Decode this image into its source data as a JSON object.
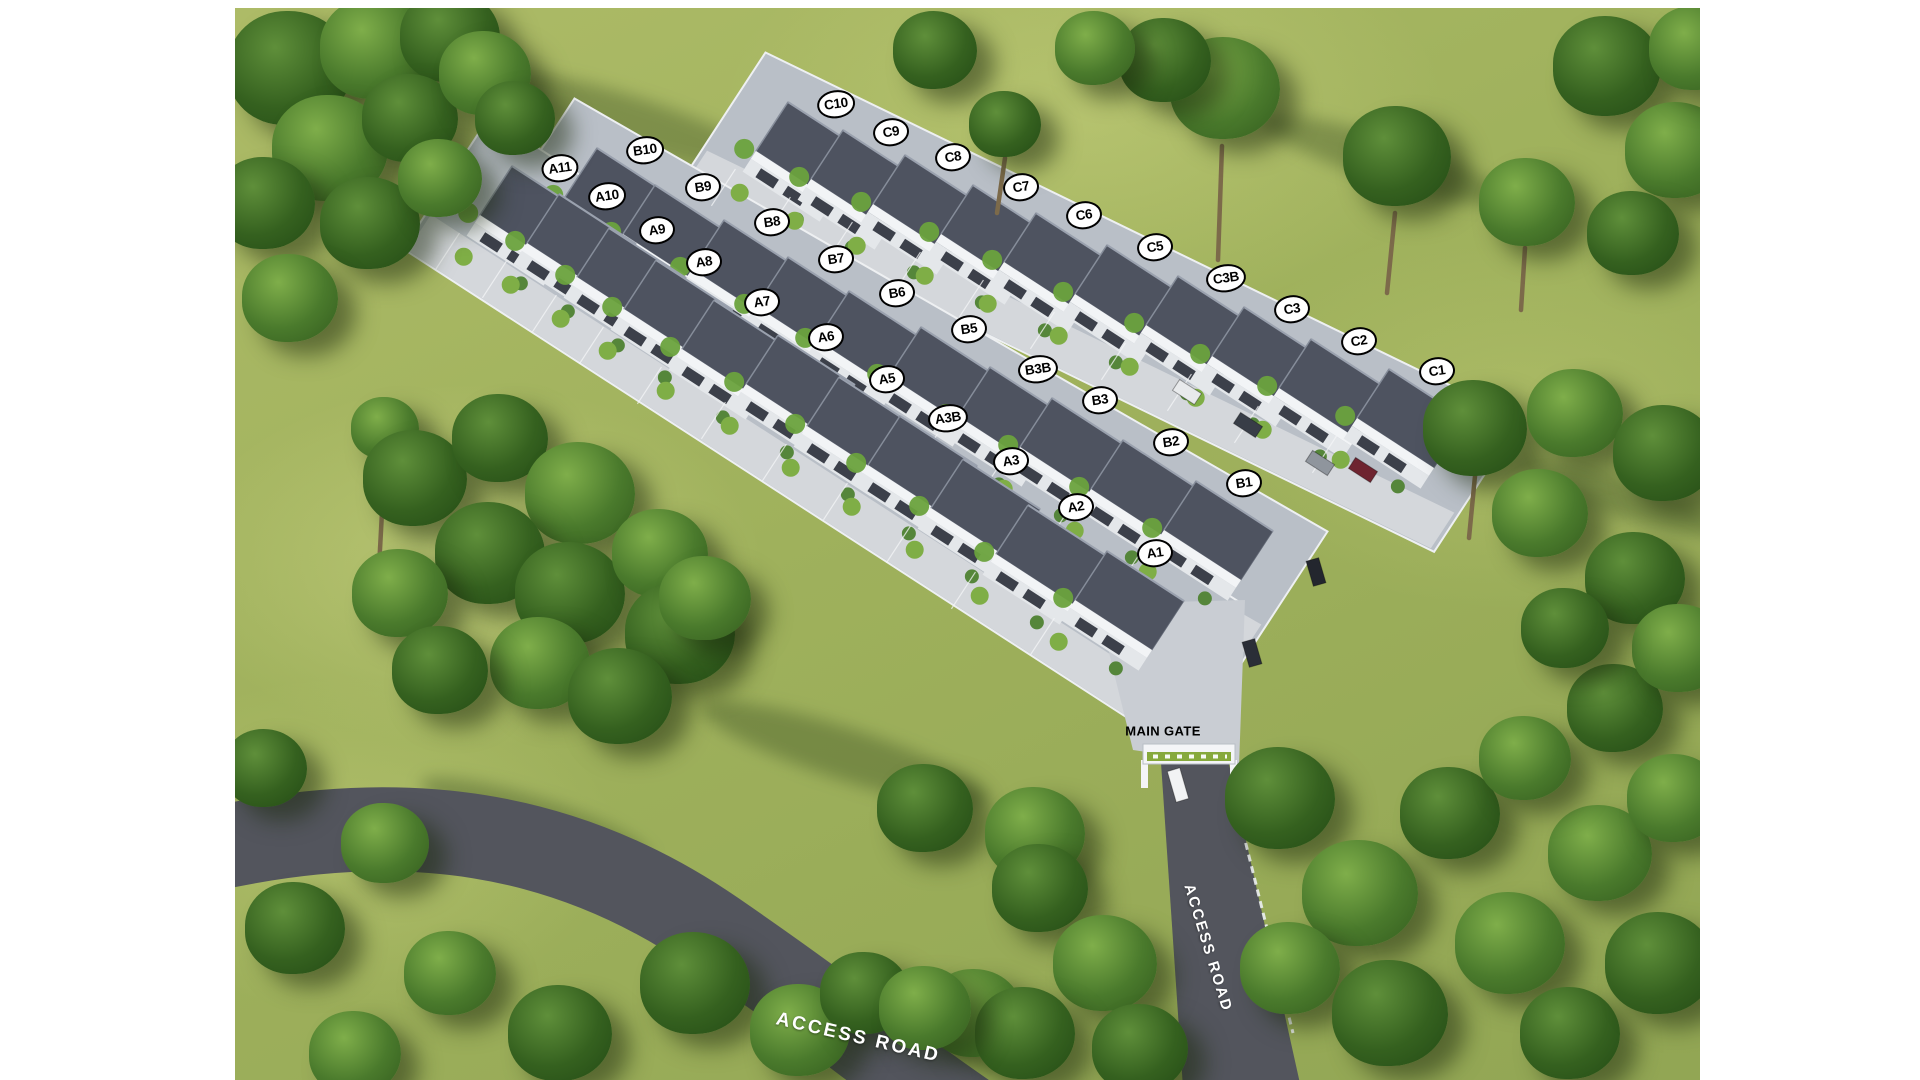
{
  "scene": {
    "type": "aerial-site-plan",
    "labels": {
      "main_gate": "MAIN GATE",
      "access_road_gate": "ACCESS ROAD",
      "access_road_main": "ACCESS ROAD"
    },
    "colors": {
      "grass": "#9fb15c",
      "tree_light": "#4a7a2c",
      "tree_dark": "#35611f",
      "road": "#53555d",
      "platform": "#b9bfc7",
      "driveway": "#d4d7db",
      "roof": "#4e5360",
      "facade": "#e4e7ea",
      "wall": "#eef0f2",
      "label_bg": "#ffffff",
      "label_border": "#000000",
      "gate_sign": "#86a93c"
    },
    "rows": [
      {
        "row": "A",
        "units": [
          {
            "id": "A11",
            "x": 325,
            "y": 160
          },
          {
            "id": "A10",
            "x": 372,
            "y": 188
          },
          {
            "id": "A9",
            "x": 422,
            "y": 222
          },
          {
            "id": "A8",
            "x": 469,
            "y": 254
          },
          {
            "id": "A7",
            "x": 527,
            "y": 294
          },
          {
            "id": "A6",
            "x": 591,
            "y": 329
          },
          {
            "id": "A5",
            "x": 652,
            "y": 371
          },
          {
            "id": "A3B",
            "x": 713,
            "y": 410
          },
          {
            "id": "A3",
            "x": 776,
            "y": 453
          },
          {
            "id": "A2",
            "x": 841,
            "y": 499
          },
          {
            "id": "A1",
            "x": 920,
            "y": 545
          }
        ]
      },
      {
        "row": "B",
        "units": [
          {
            "id": "B10",
            "x": 410,
            "y": 142
          },
          {
            "id": "B9",
            "x": 468,
            "y": 179
          },
          {
            "id": "B8",
            "x": 537,
            "y": 214
          },
          {
            "id": "B7",
            "x": 601,
            "y": 251
          },
          {
            "id": "B6",
            "x": 662,
            "y": 285
          },
          {
            "id": "B5",
            "x": 734,
            "y": 321
          },
          {
            "id": "B3B",
            "x": 803,
            "y": 361
          },
          {
            "id": "B3",
            "x": 865,
            "y": 392
          },
          {
            "id": "B2",
            "x": 936,
            "y": 434
          },
          {
            "id": "B1",
            "x": 1009,
            "y": 475
          }
        ]
      },
      {
        "row": "C",
        "units": [
          {
            "id": "C10",
            "x": 601,
            "y": 96
          },
          {
            "id": "C9",
            "x": 656,
            "y": 124
          },
          {
            "id": "C8",
            "x": 718,
            "y": 149
          },
          {
            "id": "C7",
            "x": 786,
            "y": 179
          },
          {
            "id": "C6",
            "x": 849,
            "y": 207
          },
          {
            "id": "C5",
            "x": 920,
            "y": 239
          },
          {
            "id": "C3B",
            "x": 991,
            "y": 270
          },
          {
            "id": "C3",
            "x": 1057,
            "y": 301
          },
          {
            "id": "C2",
            "x": 1124,
            "y": 333
          },
          {
            "id": "C1",
            "x": 1202,
            "y": 363
          }
        ]
      }
    ],
    "trees": [
      {
        "x": 55,
        "y": 60,
        "r": 62,
        "t": 1
      },
      {
        "x": 140,
        "y": 40,
        "r": 55,
        "t": 0
      },
      {
        "x": 215,
        "y": 28,
        "r": 50,
        "t": 1
      },
      {
        "x": 95,
        "y": 140,
        "r": 58,
        "t": 0
      },
      {
        "x": 30,
        "y": 195,
        "r": 50,
        "t": 1
      },
      {
        "x": 175,
        "y": 110,
        "r": 48,
        "t": 1
      },
      {
        "x": 250,
        "y": 65,
        "r": 46,
        "t": 0
      },
      {
        "x": 135,
        "y": 215,
        "r": 50,
        "t": 1
      },
      {
        "x": 55,
        "y": 290,
        "r": 48,
        "t": 0
      },
      {
        "x": 205,
        "y": 170,
        "r": 42,
        "t": 0
      },
      {
        "x": 280,
        "y": 110,
        "r": 40,
        "t": 1
      },
      {
        "x": 150,
        "y": 420,
        "r": 34,
        "t": 0
      },
      {
        "x": 180,
        "y": 470,
        "r": 52,
        "t": 1
      },
      {
        "x": 265,
        "y": 430,
        "r": 48,
        "t": 1
      },
      {
        "x": 345,
        "y": 485,
        "r": 55,
        "t": 0
      },
      {
        "x": 255,
        "y": 545,
        "r": 55,
        "t": 1
      },
      {
        "x": 165,
        "y": 585,
        "r": 48,
        "t": 0
      },
      {
        "x": 335,
        "y": 585,
        "r": 55,
        "t": 1
      },
      {
        "x": 425,
        "y": 545,
        "r": 48,
        "t": 0
      },
      {
        "x": 445,
        "y": 625,
        "r": 55,
        "t": 1
      },
      {
        "x": 305,
        "y": 655,
        "r": 50,
        "t": 0
      },
      {
        "x": 205,
        "y": 662,
        "r": 48,
        "t": 1
      },
      {
        "x": 385,
        "y": 688,
        "r": 52,
        "t": 1
      },
      {
        "x": 470,
        "y": 590,
        "r": 46,
        "t": 0
      },
      {
        "x": 30,
        "y": 760,
        "r": 42,
        "t": 1
      },
      {
        "x": 150,
        "y": 835,
        "r": 44,
        "t": 0
      },
      {
        "x": 60,
        "y": 920,
        "r": 50,
        "t": 1
      },
      {
        "x": 215,
        "y": 965,
        "r": 46,
        "t": 0
      },
      {
        "x": 325,
        "y": 1025,
        "r": 52,
        "t": 1
      },
      {
        "x": 120,
        "y": 1045,
        "r": 46,
        "t": 0
      },
      {
        "x": 460,
        "y": 975,
        "r": 55,
        "t": 1
      },
      {
        "x": 565,
        "y": 1022,
        "r": 50,
        "t": 0
      },
      {
        "x": 630,
        "y": 985,
        "r": 45,
        "t": 1
      },
      {
        "x": 740,
        "y": 1005,
        "r": 48,
        "t": 0
      },
      {
        "x": 690,
        "y": 800,
        "r": 48,
        "t": 1
      },
      {
        "x": 800,
        "y": 825,
        "r": 50,
        "t": 0
      },
      {
        "x": 805,
        "y": 880,
        "r": 48,
        "t": 1
      },
      {
        "x": 870,
        "y": 955,
        "r": 52,
        "t": 0
      },
      {
        "x": 790,
        "y": 1025,
        "r": 50,
        "t": 1
      },
      {
        "x": 690,
        "y": 1000,
        "r": 46,
        "t": 0
      },
      {
        "x": 905,
        "y": 1040,
        "r": 48,
        "t": 1
      },
      {
        "x": 1045,
        "y": 790,
        "r": 55,
        "t": 1
      },
      {
        "x": 1125,
        "y": 885,
        "r": 58,
        "t": 0
      },
      {
        "x": 1215,
        "y": 805,
        "r": 50,
        "t": 1
      },
      {
        "x": 1055,
        "y": 960,
        "r": 50,
        "t": 0
      },
      {
        "x": 1155,
        "y": 1005,
        "r": 58,
        "t": 1
      },
      {
        "x": 1275,
        "y": 935,
        "r": 55,
        "t": 0
      },
      {
        "x": 1335,
        "y": 1025,
        "r": 50,
        "t": 1
      },
      {
        "x": 1365,
        "y": 845,
        "r": 52,
        "t": 0
      },
      {
        "x": 1425,
        "y": 955,
        "r": 55,
        "t": 1
      },
      {
        "x": 1290,
        "y": 750,
        "r": 46,
        "t": 0
      },
      {
        "x": 1380,
        "y": 700,
        "r": 48,
        "t": 1
      },
      {
        "x": 1440,
        "y": 790,
        "r": 48,
        "t": 0
      },
      {
        "x": 1240,
        "y": 420,
        "r": 52,
        "t": 1
      },
      {
        "x": 1340,
        "y": 405,
        "r": 48,
        "t": 0
      },
      {
        "x": 1430,
        "y": 445,
        "r": 52,
        "t": 1
      },
      {
        "x": 1305,
        "y": 505,
        "r": 48,
        "t": 0
      },
      {
        "x": 1400,
        "y": 570,
        "r": 50,
        "t": 1
      },
      {
        "x": 1445,
        "y": 640,
        "r": 48,
        "t": 0
      },
      {
        "x": 1330,
        "y": 620,
        "r": 44,
        "t": 1
      },
      {
        "x": 990,
        "y": 80,
        "r": 55,
        "t": 0
      },
      {
        "x": 930,
        "y": 52,
        "r": 46,
        "t": 1
      },
      {
        "x": 1162,
        "y": 148,
        "r": 54,
        "t": 1
      },
      {
        "x": 1292,
        "y": 194,
        "r": 48,
        "t": 0
      },
      {
        "x": 1372,
        "y": 58,
        "r": 54,
        "t": 1
      },
      {
        "x": 1442,
        "y": 142,
        "r": 52,
        "t": 0
      },
      {
        "x": 1398,
        "y": 225,
        "r": 46,
        "t": 1
      },
      {
        "x": 1460,
        "y": 40,
        "r": 46,
        "t": 0
      },
      {
        "x": 700,
        "y": 42,
        "r": 42,
        "t": 1
      },
      {
        "x": 770,
        "y": 116,
        "r": 36,
        "t": 1
      },
      {
        "x": 860,
        "y": 40,
        "r": 40,
        "t": 0
      }
    ],
    "trunks": [
      [
        987,
        138,
        983,
        252
      ],
      [
        1160,
        205,
        1152,
        285
      ],
      [
        1290,
        240,
        1286,
        302
      ],
      [
        770,
        150,
        762,
        205
      ],
      [
        150,
        448,
        144,
        560
      ],
      [
        1240,
        468,
        1234,
        530
      ]
    ],
    "cars": [
      {
        "x": 952,
        "y": 384,
        "c": "#e8eaec",
        "d": "row"
      },
      {
        "x": 1013,
        "y": 417,
        "c": "#383d47",
        "d": "row"
      },
      {
        "x": 1085,
        "y": 455,
        "c": "#8f959d",
        "d": "row"
      },
      {
        "x": 1128,
        "y": 462,
        "c": "#6e2430",
        "d": "row"
      },
      {
        "x": 1081,
        "y": 564,
        "c": "#23262e",
        "d": "road"
      },
      {
        "x": 1017,
        "y": 645,
        "c": "#2a2e37",
        "d": "road"
      },
      {
        "x": 943,
        "y": 777,
        "c": "#f2f3f4",
        "d": "road",
        "l": 16
      }
    ]
  }
}
